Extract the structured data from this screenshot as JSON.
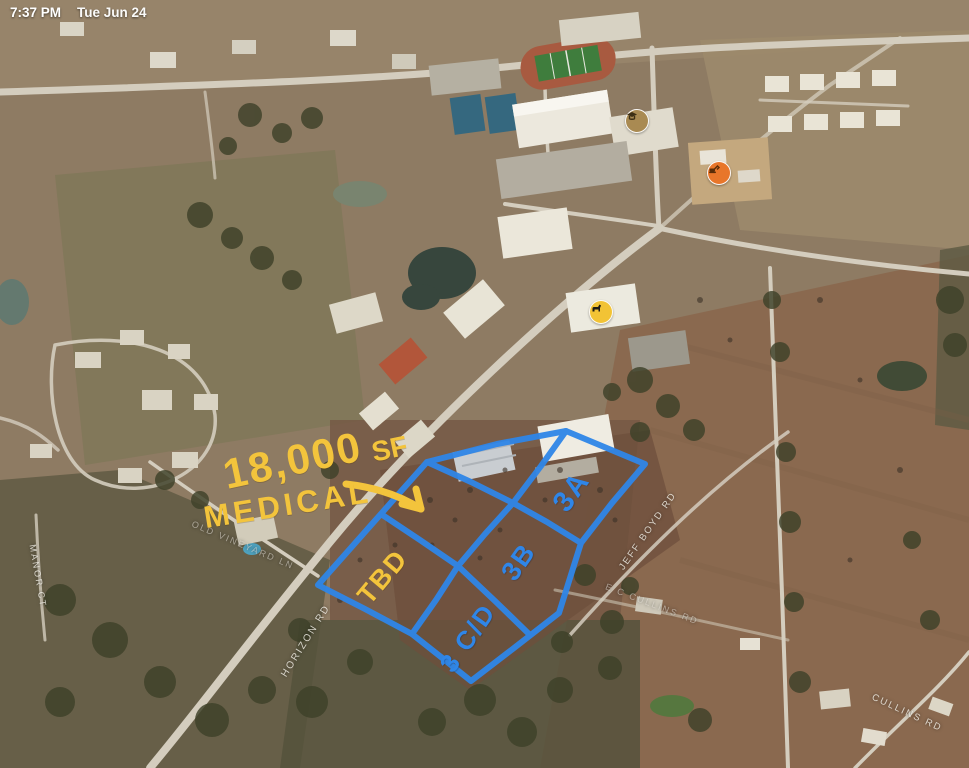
{
  "status_bar": {
    "time": "7:37 PM",
    "date": "Tue Jun 24"
  },
  "note": {
    "size": "18,000",
    "unit": "SF",
    "use": "MEDICAL"
  },
  "lots": {
    "tbd": {
      "label": "TBD"
    },
    "cd": {
      "label": "3 C/D"
    },
    "b": {
      "label": "3B"
    },
    "a": {
      "label": "3A"
    }
  },
  "road_labels": {
    "old_vineyard": "OLD VINEYARD LN",
    "horizon": "HORIZON RD",
    "manor": "MANOR CT",
    "jeff_boyd": "JEFF BOYD RD",
    "ec_cullins": "E C CULLINS RD",
    "cullins": "CULLINS RD"
  },
  "markers": [
    {
      "name": "school",
      "color": "#a98a52"
    },
    {
      "name": "construction",
      "color": "#e8762a"
    },
    {
      "name": "animal",
      "color": "#f2c335"
    }
  ],
  "colors": {
    "annotation_blue": "#2f86e8",
    "annotation_yellow": "#f3c43c"
  }
}
